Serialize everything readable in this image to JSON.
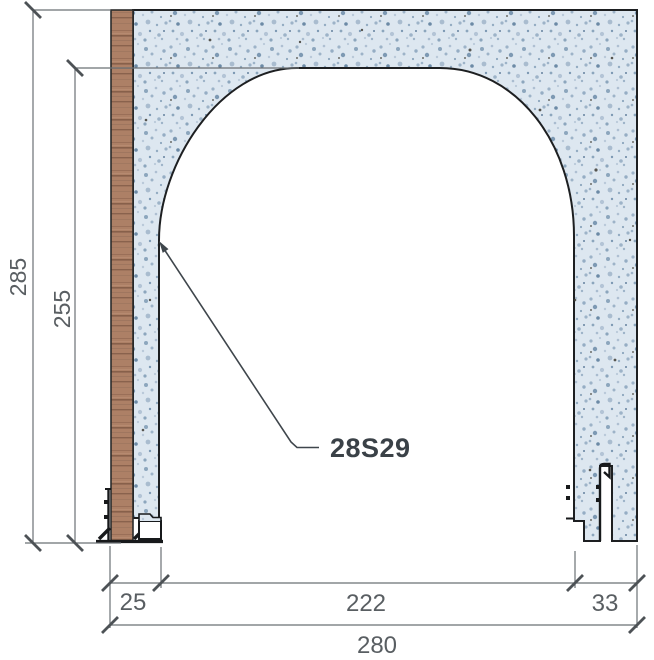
{
  "drawing": {
    "type": "technical-section-detail",
    "callout": {
      "label": "28S29"
    },
    "dimensions": {
      "overall_height": "285",
      "opening_height": "255",
      "left_jamb": "25",
      "opening_width": "222",
      "right_jamb": "33",
      "overall_width": "280"
    },
    "colors": {
      "material_base": "#dde7f0",
      "speckle_dark": "#7d99b3",
      "wood_base": "#ad8066",
      "outline": "#1d1f21",
      "profile": "#17191b",
      "dimension_line": "#6b7074",
      "tick": "#4d5256",
      "dimension_text": "#595e62",
      "label_text": "#3a4147"
    }
  }
}
